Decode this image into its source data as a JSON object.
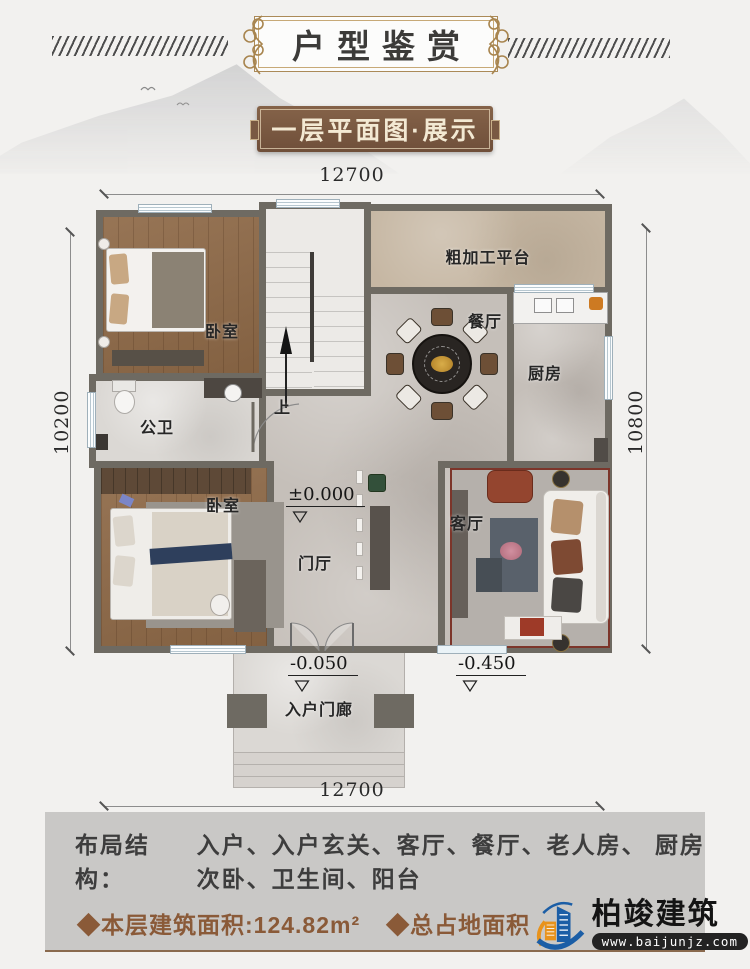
{
  "header": {
    "title": "户型鉴赏",
    "subtitle": "一层平面图·展示"
  },
  "plan": {
    "dims": {
      "top": "12700",
      "bottom": "12700",
      "left": "10200",
      "right": "10800"
    },
    "rooms": {
      "bedroom_top": "卧室",
      "bathroom": "公卫",
      "bedroom_bottom": "卧室",
      "platform": "粗加工平台",
      "dining": "餐厅",
      "kitchen": "厨房",
      "living": "客厅",
      "foyer": "门厅",
      "porch": "入户门廊",
      "stairs_up": "上"
    },
    "levels": {
      "ground": "±0.000",
      "porch": "-0.050",
      "yard": "-0.450"
    }
  },
  "info": {
    "layout_label": "布局结构：",
    "layout_line1": "入户、入户玄关、客厅、餐厅、老人房、 厨房",
    "layout_line2": "次卧、卫生间、阳台",
    "floor_area": "◆本层建筑面积:124.82m²",
    "total_area": "◆总占地面积"
  },
  "logo": {
    "name": "柏竣建筑",
    "website": "www.baijunjz.com"
  },
  "colors": {
    "wall": "#6e6a62",
    "gold_frame": "#ab8a58",
    "banner_brown": "#7a5942",
    "area_text_brown": "#8a5a38",
    "logo_blue": "#1b5ea6",
    "logo_orange": "#e8931c",
    "info_panel_gray": "#c9c8c6"
  }
}
